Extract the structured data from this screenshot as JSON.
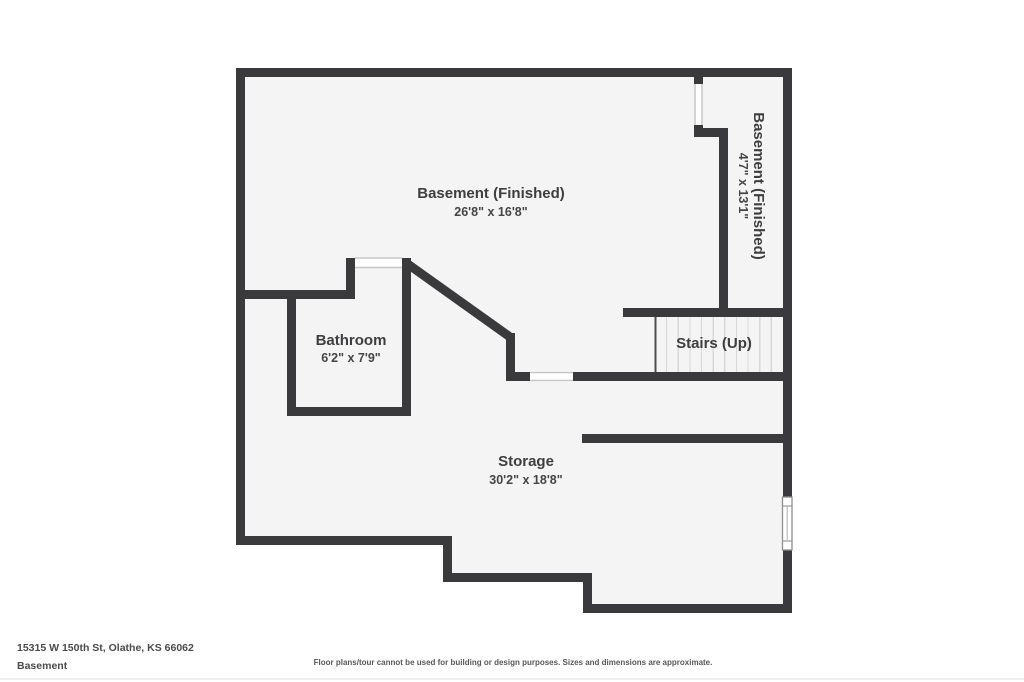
{
  "plan": {
    "colors": {
      "wall": "#3a3a3c",
      "floor": "#f4f4f4",
      "label_text": "#3e3e40",
      "stair_tread": "#d8d8d8",
      "opening_line": "#c6c6c6"
    },
    "rooms": {
      "basement_main": {
        "name": "Basement (Finished)",
        "dims": "26'8\" x 16'8\""
      },
      "basement_side": {
        "name": "Basement (Finished)",
        "dims": "4'7\" x 13'1\""
      },
      "bathroom": {
        "name": "Bathroom",
        "dims": "6'2\" x 7'9\""
      },
      "stairs": {
        "name": "Stairs (Up)"
      },
      "storage": {
        "name": "Storage",
        "dims": "30'2\" x 18'8\""
      }
    }
  },
  "footer": {
    "address": "15315 W 150th St, Olathe, KS 66062",
    "floor_label": "Basement",
    "disclaimer": "Floor plans/tour cannot be used for building or design purposes. Sizes and dimensions are approximate."
  }
}
